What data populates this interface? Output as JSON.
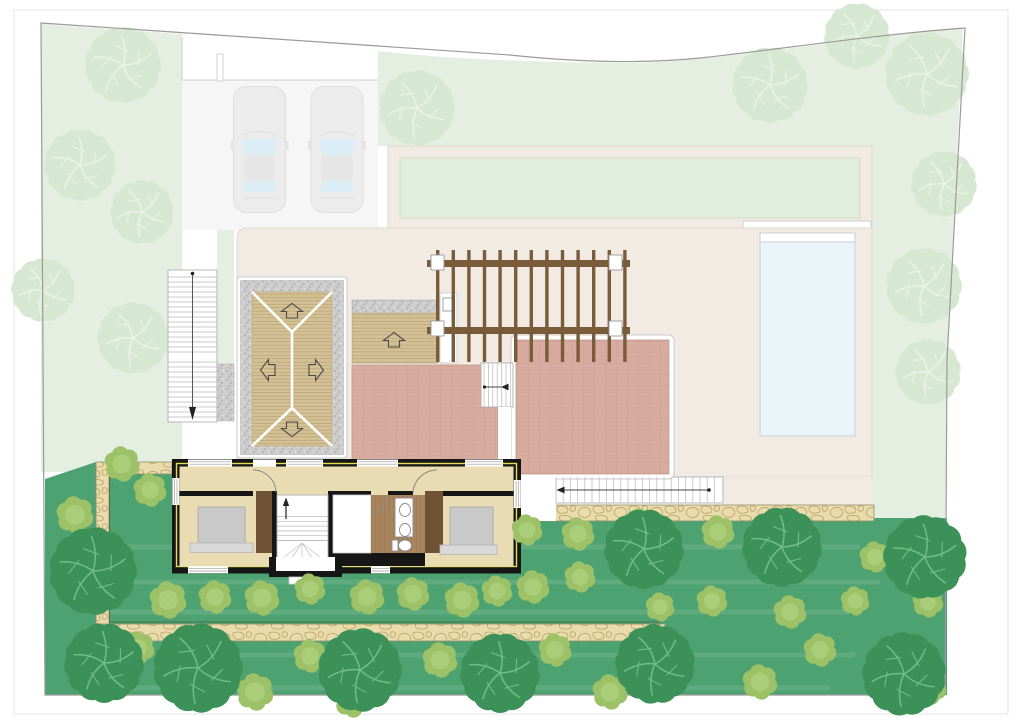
{
  "plan": {
    "kind": "residential-villa-site-plan",
    "visible_text": []
  },
  "colors": {
    "page_bg": "#ffffff",
    "frame": "#e4e4e4",
    "boundary": "#9a9a9a",
    "site_fill": "#ffffff",
    "pale_green": "#e4efe1",
    "faded_tree": "#d7e8d2",
    "faded_tree_branch": "#e9f3e6",
    "lawn_upper": "#e2eedd",
    "driveway": "#f6f6f6",
    "car_body": "#ececec",
    "car_glass": "#dbedf6",
    "cream": "#f2ebe3",
    "cream_line": "#e2d9cd",
    "pool": "#eaf4f9",
    "pool_edge": "#c4d3da",
    "garden": "#4da271",
    "garden_stripe": "rgba(255,255,255,0.10)",
    "bush": "#9cc167",
    "bush_inner": "#a9cd78",
    "tree_dark": "#3c9158",
    "tree_branch": "#6fbe89",
    "stone_bg": "#eadbab",
    "stone_line": "#b29a62",
    "gravel": "#cccccc",
    "gravel_dot": "#9f9f9f",
    "wood": "#d3c094",
    "wood_line": "#a5905e",
    "pergola": "#7a5b3a",
    "pink": "#d7ab9f",
    "pink_line": "#bb8a7d",
    "wall": "#161616",
    "insulation": "#e3df4e",
    "floor": "#e9dcb2",
    "bath_floor": "#a9855e",
    "bath_floor_line": "#8a6946",
    "furniture_brown": "#6f5136",
    "bed": "#c9c9c9",
    "bed_base": "#d9d9d9",
    "stair_bg": "#ffffff",
    "outline_gray": "#c9c9c9"
  },
  "landscape": {
    "faded_trees": [
      [
        123,
        65,
        38
      ],
      [
        80,
        165,
        36
      ],
      [
        142,
        212,
        32
      ],
      [
        43,
        290,
        32
      ],
      [
        133,
        338,
        36
      ],
      [
        417,
        108,
        38
      ],
      [
        770,
        85,
        38
      ],
      [
        857,
        36,
        33
      ],
      [
        927,
        74,
        42
      ],
      [
        944,
        184,
        33
      ],
      [
        924,
        286,
        38
      ],
      [
        928,
        372,
        33
      ]
    ],
    "dark_trees": [
      [
        93,
        571,
        44
      ],
      [
        104,
        663,
        40
      ],
      [
        198,
        668,
        45
      ],
      [
        360,
        670,
        42
      ],
      [
        500,
        673,
        40
      ],
      [
        644,
        549,
        40
      ],
      [
        782,
        547,
        40
      ],
      [
        925,
        557,
        42
      ],
      [
        655,
        664,
        40
      ],
      [
        904,
        674,
        42
      ]
    ],
    "bushes": [
      [
        122,
        464,
        17
      ],
      [
        75,
        515,
        18
      ],
      [
        150,
        490,
        16
      ],
      [
        168,
        600,
        18
      ],
      [
        215,
        597,
        16
      ],
      [
        262,
        598,
        17
      ],
      [
        310,
        589,
        15
      ],
      [
        367,
        597,
        17
      ],
      [
        413,
        594,
        16
      ],
      [
        462,
        600,
        17
      ],
      [
        497,
        591,
        15
      ],
      [
        533,
        587,
        16
      ],
      [
        580,
        577,
        15
      ],
      [
        527,
        530,
        15
      ],
      [
        578,
        534,
        16
      ],
      [
        640,
        524,
        15
      ],
      [
        718,
        532,
        16
      ],
      [
        772,
        527,
        14
      ],
      [
        138,
        648,
        16
      ],
      [
        255,
        692,
        18
      ],
      [
        310,
        656,
        16
      ],
      [
        352,
        700,
        17
      ],
      [
        440,
        660,
        17
      ],
      [
        555,
        650,
        16
      ],
      [
        610,
        692,
        17
      ],
      [
        662,
        656,
        15
      ],
      [
        760,
        682,
        17
      ],
      [
        820,
        650,
        16
      ],
      [
        930,
        688,
        16
      ],
      [
        660,
        607,
        14
      ],
      [
        712,
        601,
        15
      ],
      [
        790,
        612,
        16
      ],
      [
        855,
        601,
        14
      ],
      [
        928,
        602,
        15
      ],
      [
        875,
        557,
        15
      ]
    ],
    "stripes": [
      [
        100,
        547,
        860
      ],
      [
        65,
        582,
        880
      ],
      [
        100,
        612,
        850
      ],
      [
        75,
        655,
        855
      ],
      [
        105,
        688,
        830
      ]
    ]
  },
  "pergola": {
    "beam_x": 427,
    "beam_w": 203,
    "beam_ys": [
      260,
      327
    ],
    "beam_h": 7,
    "slat_x0": 436,
    "slat_step": 15.6,
    "slat_count": 13,
    "slat_w": 3.4,
    "slat_y": 250,
    "slat_h": 112,
    "connectors": [
      [
        431,
        255
      ],
      [
        609,
        255
      ],
      [
        431,
        321
      ],
      [
        609,
        321
      ]
    ],
    "connector_w": 13,
    "connector_h": 15
  },
  "stair_runs": [
    {
      "x": 168,
      "y": 277,
      "len": 49,
      "count": 16,
      "step": 5,
      "dir": "h",
      "layer": "ext"
    },
    {
      "x": 168,
      "y": 362,
      "len": 49,
      "count": 12,
      "step": 5,
      "dir": "h",
      "layer": "ext"
    },
    {
      "x": 556,
      "y": 477,
      "len": 26,
      "count": 23,
      "step": 7.2,
      "dir": "v",
      "layer": "ext"
    },
    {
      "x": 484,
      "y": 363,
      "len": 44,
      "count": 7,
      "step": 4.4,
      "dir": "v",
      "layer": "ext"
    },
    {
      "x": 277,
      "y": 516.5,
      "len": 51,
      "count": 6,
      "step": 4.8,
      "dir": "h",
      "layer": "int"
    }
  ],
  "building": {
    "windows": {
      "top": [
        [
          188,
          232
        ],
        [
          286,
          323
        ],
        [
          357,
          398
        ],
        [
          465,
          503
        ]
      ],
      "top_door": [
        253,
        276
      ],
      "bottom": [
        [
          188,
          228
        ],
        [
          371,
          390
        ]
      ],
      "left": [
        478,
        505
      ],
      "right": [
        480,
        508
      ]
    }
  },
  "cars": {
    "positions": [
      [
        233,
        86
      ],
      [
        310.5,
        86
      ]
    ]
  }
}
